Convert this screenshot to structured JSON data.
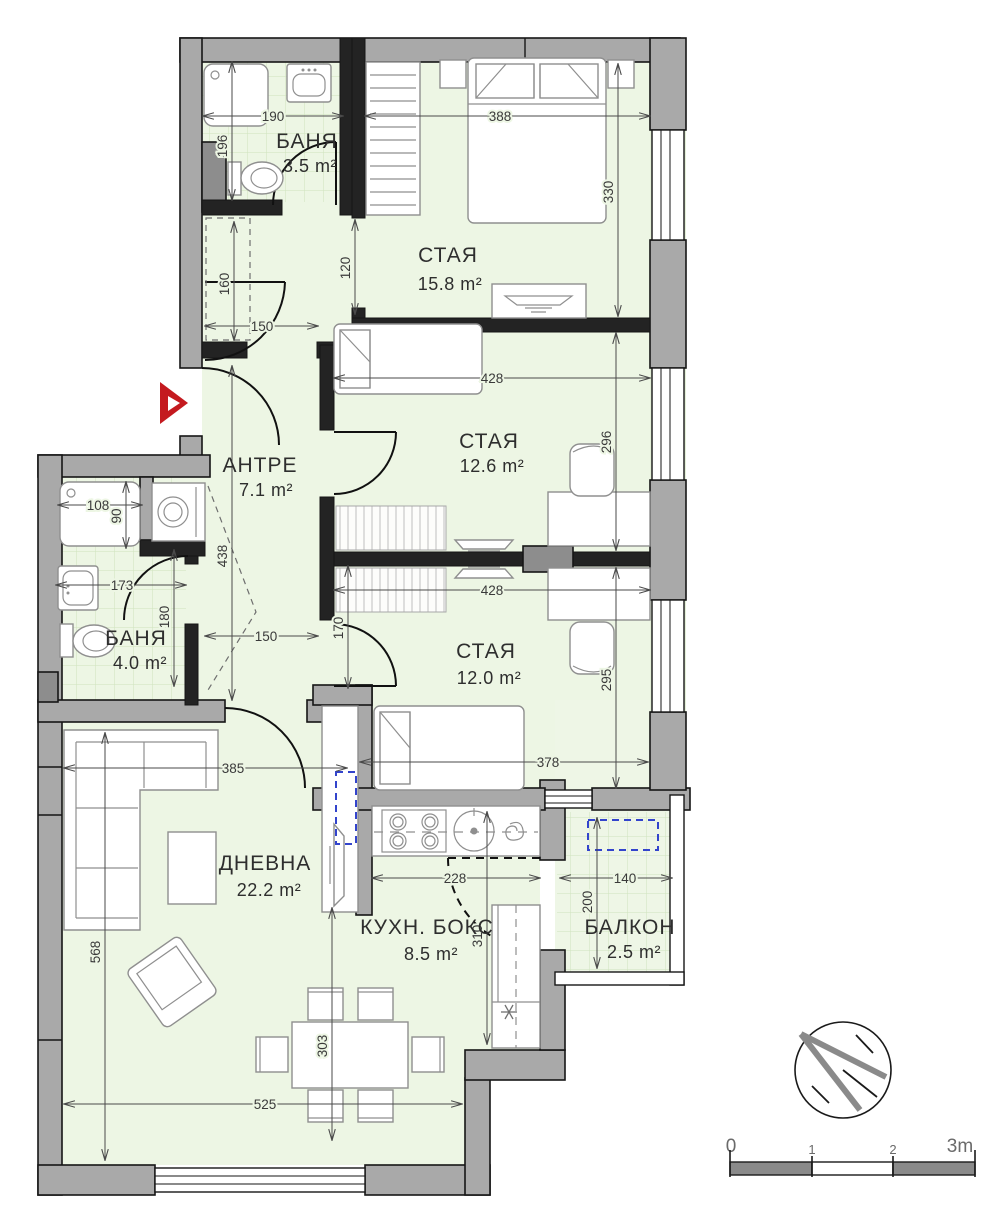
{
  "rooms": {
    "bath_top": {
      "name": "БАНЯ",
      "area": "3.5 m²"
    },
    "bedroom1": {
      "name": "СТАЯ",
      "area": "15.8 m²"
    },
    "bedroom2": {
      "name": "СТАЯ",
      "area": "12.6 m²"
    },
    "bedroom3": {
      "name": "СТАЯ",
      "area": "12.0 m²"
    },
    "hallway": {
      "name": "АНТРЕ",
      "area": "7.1 m²"
    },
    "bath_left": {
      "name": "БАНЯ",
      "area": "4.0 m²"
    },
    "living": {
      "name": "ДНЕВНА",
      "area": "22.2 m²"
    },
    "kitchen": {
      "name": "КУХН. БОКС",
      "area": "8.5 m²"
    },
    "balcony": {
      "name": "БАЛКОН",
      "area": "2.5 m²"
    }
  },
  "dims": {
    "bath_top": {
      "w": "190",
      "h": "196"
    },
    "bedroom1": {
      "w": "388",
      "h": "330",
      "opening": "120"
    },
    "corridor": {
      "closet": "160",
      "w": "150"
    },
    "bedroom2": {
      "w": "428",
      "h": "296"
    },
    "bedroom3": {
      "w": "428",
      "h": "295",
      "w2": "378"
    },
    "hall": {
      "h": "438",
      "w": "150",
      "pass": "170"
    },
    "bath_left": {
      "shower_w": "108",
      "shower_h": "90",
      "w": "173",
      "h": "180"
    },
    "living": {
      "w": "385",
      "h": "568",
      "w2": "525",
      "dining": "303"
    },
    "kitchen": {
      "w": "228",
      "h": "310"
    },
    "balcony": {
      "w": "140",
      "h": "200"
    }
  },
  "scale_bar": {
    "l0": "0",
    "l1": "1",
    "l2": "2",
    "l3": "3m"
  },
  "colors": {
    "wall": "#a9a9a9",
    "room_fill": "#edf6e4",
    "entrance_red": "#c41a1f",
    "ac_blue": "#3344cc"
  }
}
